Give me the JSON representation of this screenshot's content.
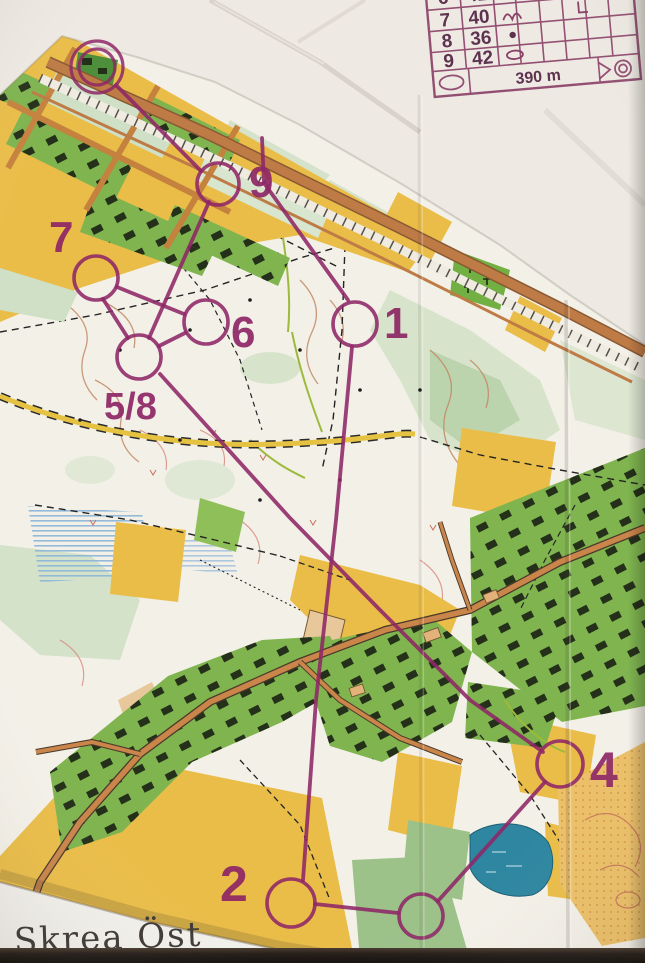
{
  "photo": {
    "map_title": "Skrea Öst"
  },
  "colors": {
    "course_purple": "#8E2766",
    "open_yellow": "#EABD49",
    "residential_green": "#7FB44F",
    "pale_green": "#D7E4CB",
    "road_orange": "#C9854A",
    "lake_teal": "#2E86A0",
    "sand_orange": "#ECC068",
    "contour_brown": "#C28A66",
    "paper_white": "#EDE9E2"
  },
  "course": {
    "finish": {
      "cx": 97,
      "cy": 67,
      "r_outer": 26,
      "r_inner": 18
    },
    "controls": [
      {
        "label": "1",
        "cx": 355,
        "cy": 324,
        "r": 22,
        "lx": 384,
        "ly": 338,
        "fs": 44
      },
      {
        "label": "2",
        "cx": 291,
        "cy": 903,
        "r": 24,
        "lx": 220,
        "ly": 901,
        "fs": 50
      },
      {
        "label": "",
        "cx": 421,
        "cy": 916,
        "r": 22,
        "lx": 0,
        "ly": 0,
        "fs": 0
      },
      {
        "label": "4",
        "cx": 560,
        "cy": 764,
        "r": 23,
        "lx": 590,
        "ly": 787,
        "fs": 50
      },
      {
        "label": "5/8",
        "cx": 139,
        "cy": 357,
        "r": 22,
        "lx": 104,
        "ly": 419,
        "fs": 38
      },
      {
        "label": "6",
        "cx": 206,
        "cy": 322,
        "r": 22,
        "lx": 231,
        "ly": 347,
        "fs": 44
      },
      {
        "label": "7",
        "cx": 96,
        "cy": 278,
        "r": 22,
        "lx": 49,
        "ly": 252,
        "fs": 44
      },
      {
        "label": "9",
        "cx": 218,
        "cy": 184,
        "r": 21,
        "lx": 249,
        "ly": 197,
        "fs": 44
      }
    ],
    "legs": [
      [
        [
          262,
          138
        ],
        [
          264,
          183
        ],
        [
          348,
          300
        ]
      ],
      [
        [
          352,
          347
        ],
        [
          336,
          520
        ],
        [
          316,
          700
        ],
        [
          303,
          880
        ]
      ],
      [
        [
          315,
          904
        ],
        [
          398,
          913
        ]
      ],
      [
        [
          438,
          901
        ],
        [
          545,
          782
        ]
      ],
      [
        [
          543,
          752
        ],
        [
          470,
          700
        ],
        [
          380,
          610
        ],
        [
          290,
          518
        ],
        [
          160,
          374
        ]
      ],
      [
        [
          159,
          346
        ],
        [
          185,
          333
        ]
      ],
      [
        [
          184,
          314
        ],
        [
          117,
          287
        ]
      ],
      [
        [
          103,
          299
        ],
        [
          128,
          338
        ]
      ],
      [
        [
          149,
          338
        ],
        [
          209,
          202
        ]
      ],
      [
        [
          201,
          171
        ],
        [
          116,
          85
        ]
      ]
    ]
  },
  "control_descriptions": {
    "rows": [
      {
        "number": "6",
        "code": "41",
        "symbols": []
      },
      {
        "number": "7",
        "code": "40",
        "symbols": [
          "mound",
          "bend"
        ]
      },
      {
        "number": "8",
        "code": "36",
        "symbols": [
          "boulder-dot"
        ]
      },
      {
        "number": "9",
        "code": "42",
        "symbols": [
          "depression-oval"
        ]
      }
    ],
    "footer": {
      "distance": "390 m"
    }
  }
}
